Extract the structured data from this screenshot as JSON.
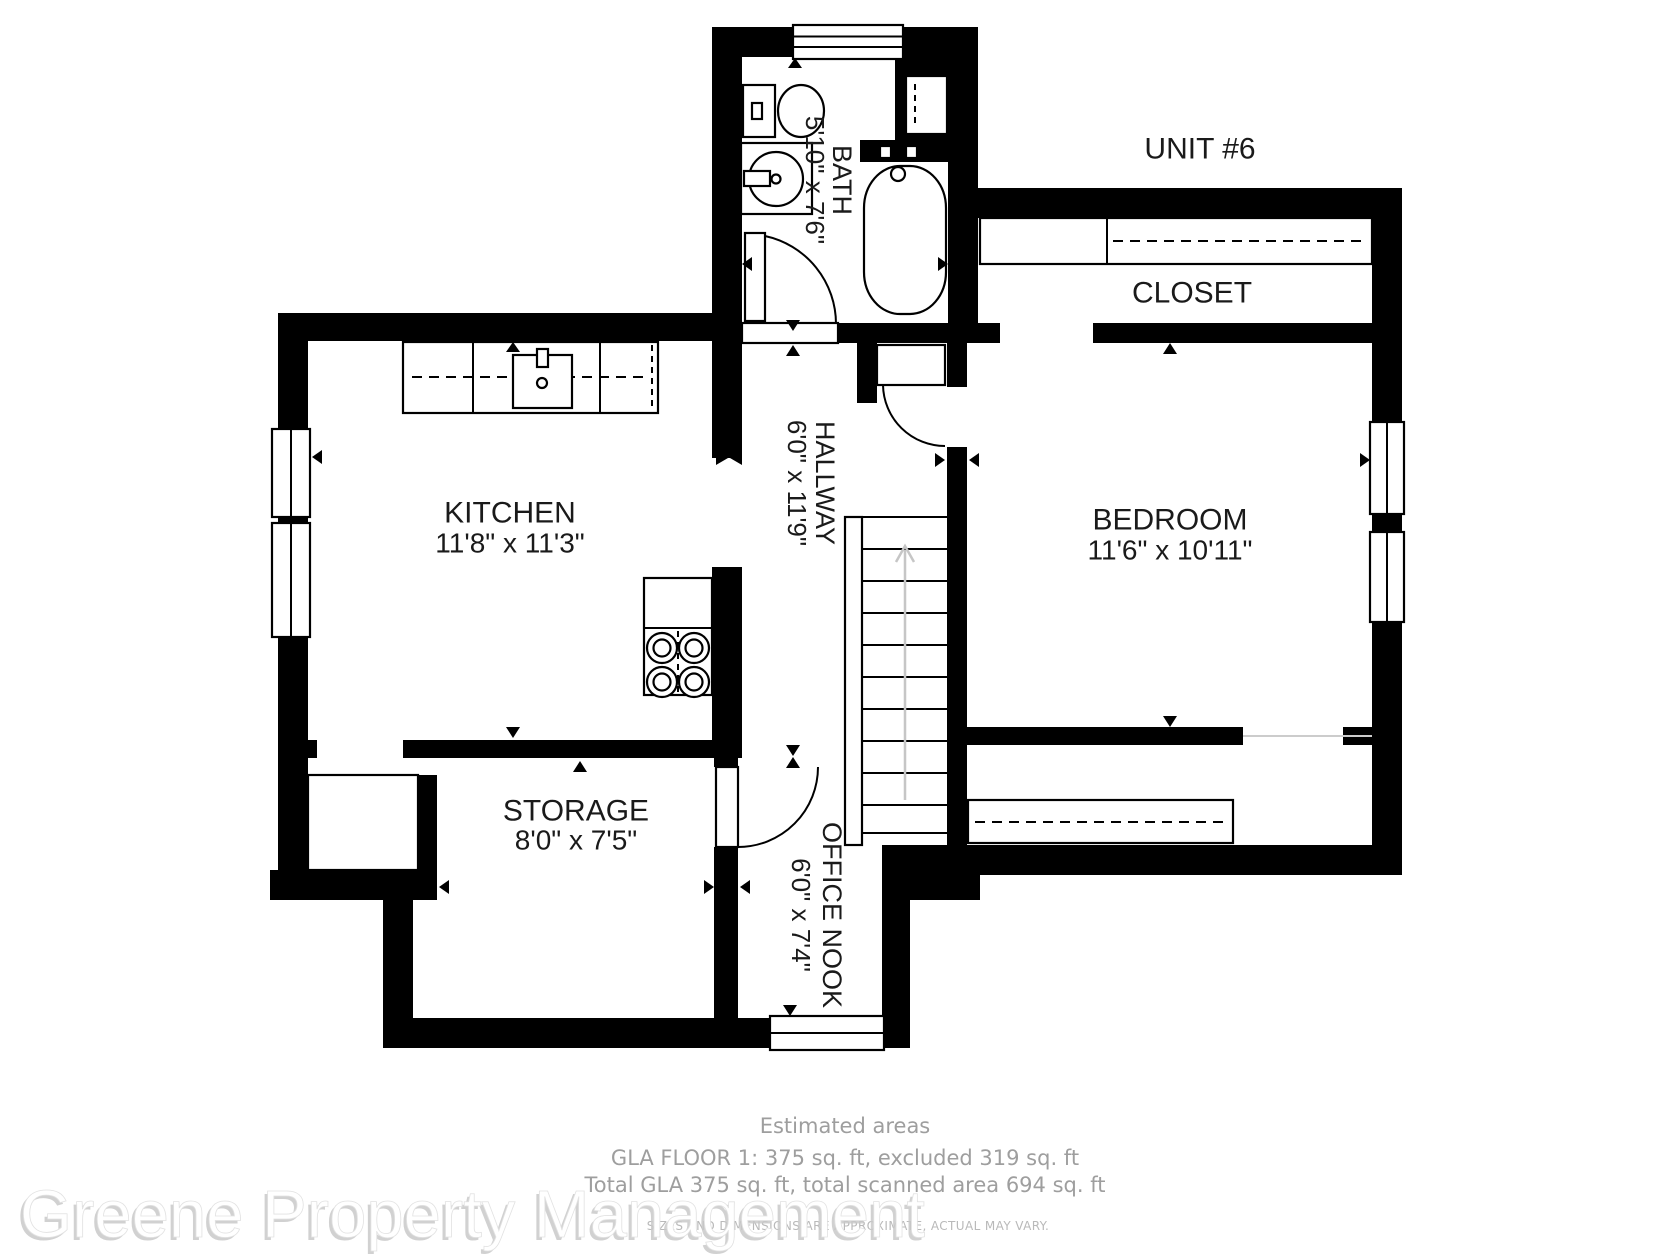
{
  "unit_label": "UNIT #6",
  "rooms": {
    "bath": {
      "name": "BATH",
      "dims": "5'10\" x 7'6\""
    },
    "closet": {
      "name": "CLOSET"
    },
    "kitchen": {
      "name": "KITCHEN",
      "dims": "11'8\" x 11'3\""
    },
    "hallway": {
      "name": "HALLWAY",
      "dims": "6'0\" x 11'9\""
    },
    "bedroom": {
      "name": "BEDROOM",
      "dims": "11'6\" x 10'11\""
    },
    "storage": {
      "name": "STORAGE",
      "dims": "8'0\" x 7'5\""
    },
    "office_nook": {
      "name": "OFFICE NOOK",
      "dims": "6'0\" x 7'4\""
    }
  },
  "footer": {
    "heading": "Estimated areas",
    "line1": "GLA FLOOR 1: 375 sq. ft, excluded 319 sq. ft",
    "line2": "Total GLA 375 sq. ft, total scanned area 694 sq. ft",
    "disclaimer": "SIZES AND DIMENSIONS ARE APPROXIMATE, ACTUAL MAY VARY."
  },
  "watermark": "Greene Property Management",
  "colors": {
    "wall": "#000000",
    "stair_arrow": "#c6c6c6",
    "opening_line": "#cccccc",
    "label_text": "#1a1a1a",
    "footer_text": "#9e9e9e",
    "disclaimer_text": "#b9b9b9",
    "watermark_shadow": "#c9c9c9"
  }
}
